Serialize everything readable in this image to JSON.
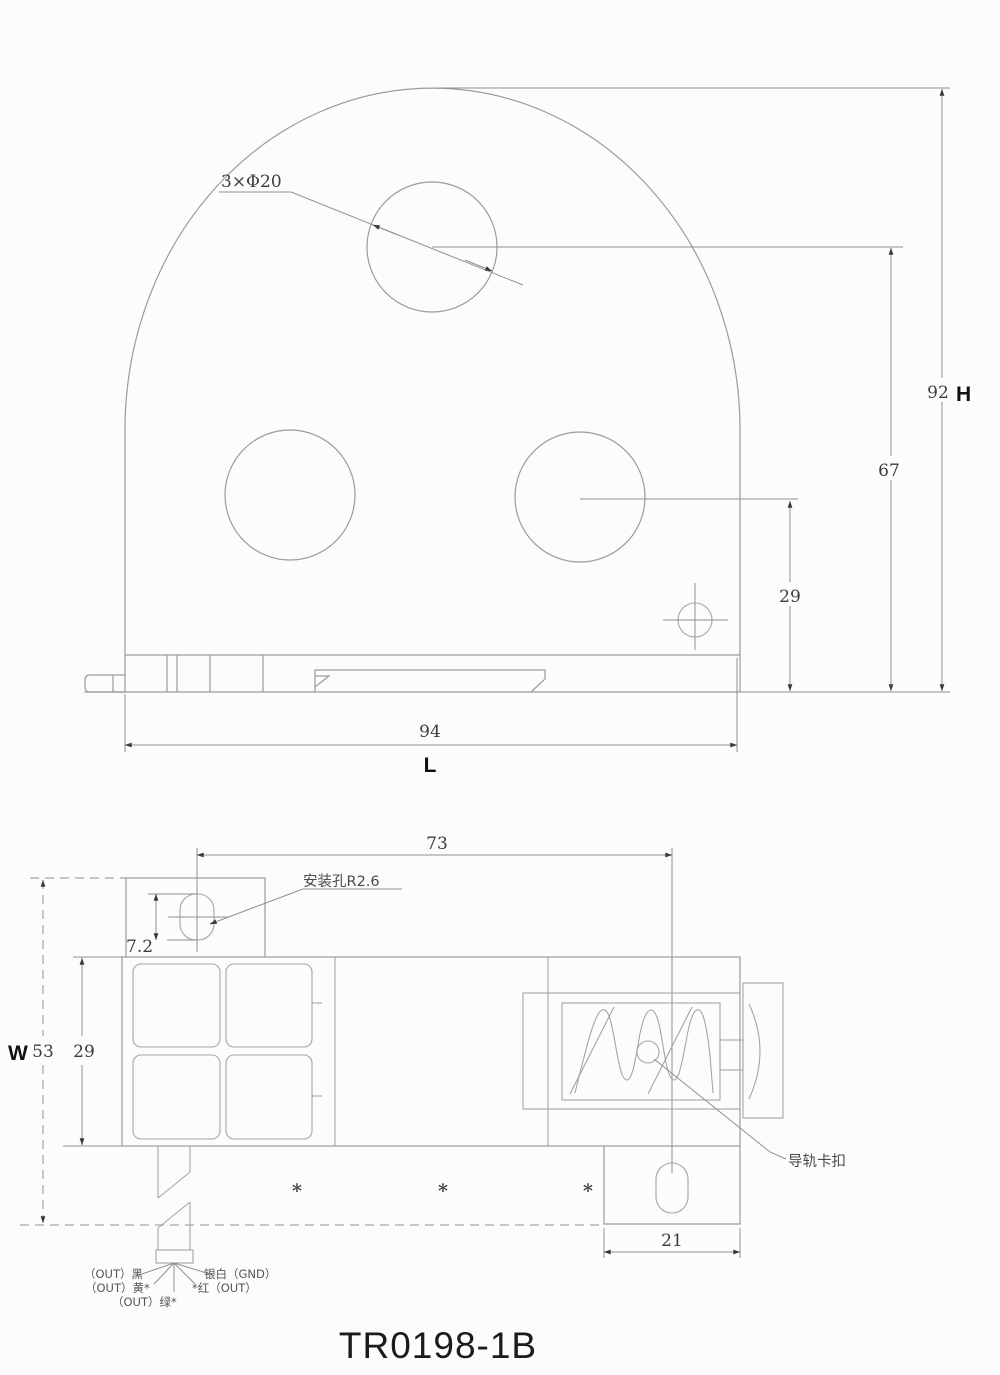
{
  "title": "TR0198-1B",
  "front_view": {
    "hole_note": "3×Φ20",
    "dims": {
      "total_height": "92",
      "total_height_label": "H",
      "hole_center_height": "67",
      "lower_hole_height": "29",
      "total_width": "94",
      "total_width_label": "L"
    }
  },
  "side_view": {
    "notes": {
      "mounting_hole": "安装孔R2.6",
      "rail_clip": "导轨卡扣"
    },
    "dims": {
      "hole_spacing": "73",
      "slot_height": "7.2",
      "total_depth_label": "W",
      "total_depth": "53",
      "body_depth": "29",
      "tab_width": "21"
    },
    "footnote_marks": [
      "*",
      "*",
      "*"
    ],
    "wire_labels": {
      "black_out": "（OUT）黑",
      "silver_gnd": "银白（GND）",
      "yellow_out": "（OUT）黄*",
      "red_out": "*红（OUT）",
      "green_out": "（OUT）绿*"
    }
  }
}
